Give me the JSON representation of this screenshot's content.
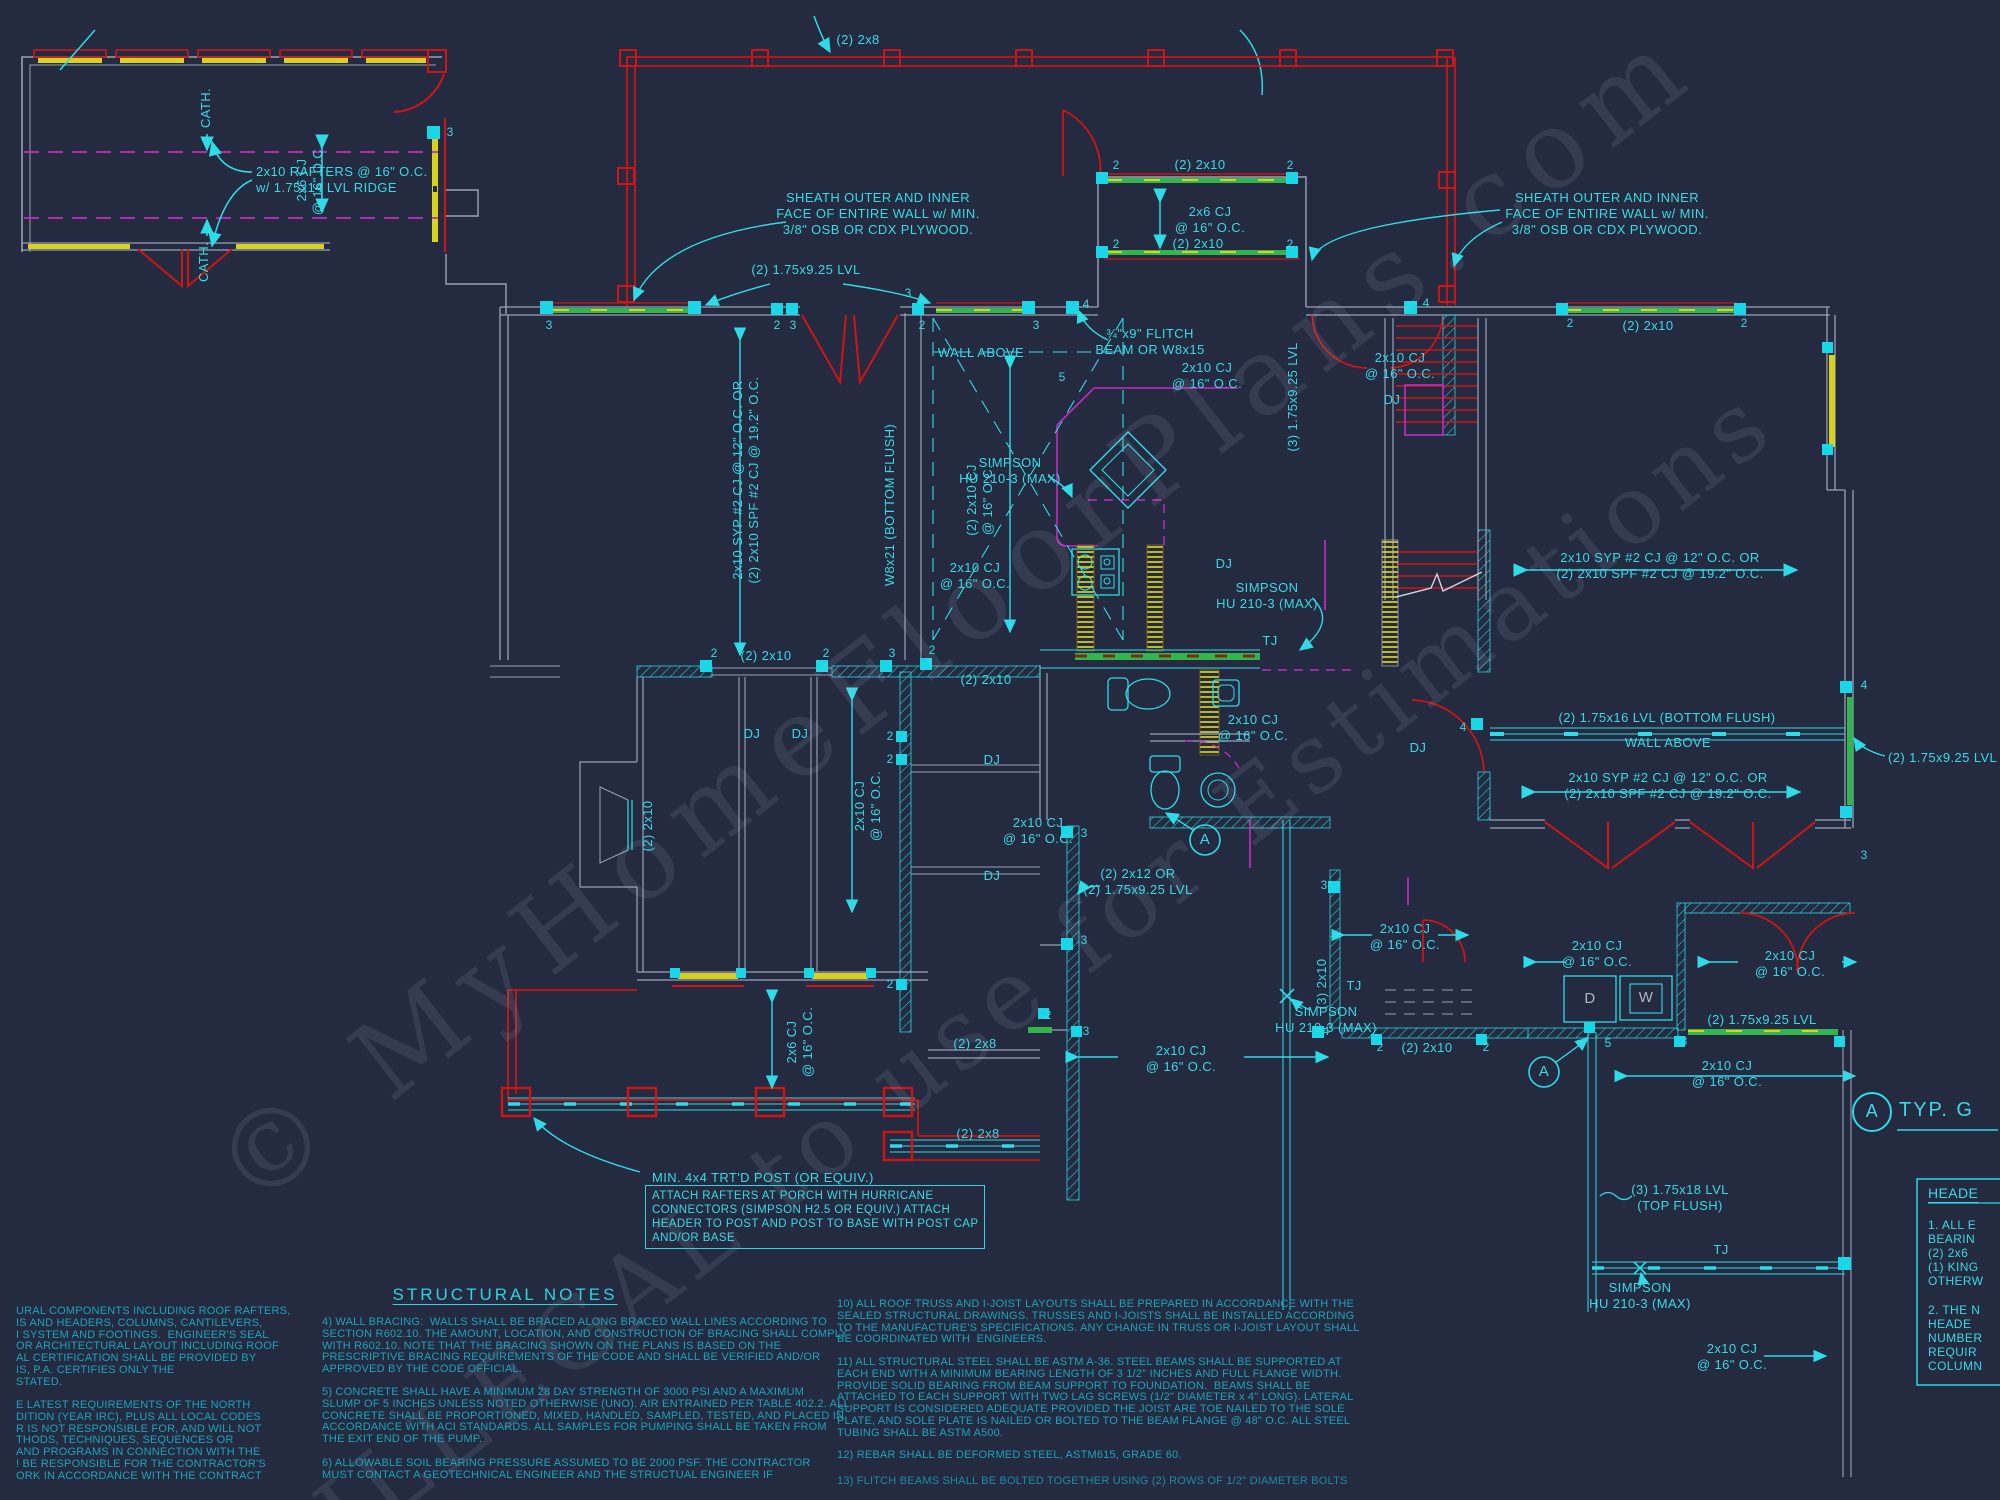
{
  "watermark": {
    "line1": "© MyHomeFloorPlans.com",
    "line2": "ILLEGAL to use for Estimations"
  },
  "colors": {
    "background": "#242a3f",
    "cyan": "#2fdbe6",
    "red": "#cf1414",
    "yellow": "#d8d21f",
    "green": "#33b54e",
    "magenta": "#c32ac3",
    "gray": "#9aa2b6"
  },
  "shared": {
    "cj_2x10": [
      "2x10 CJ",
      "@ 16\" O.C."
    ],
    "cj_2x10_2": [
      "(2) 2x10 CJ",
      "@ 16\" O.C."
    ],
    "cj_2x6": [
      "2x6 CJ",
      "@ 16\" O.C."
    ],
    "two_2x10": "(2) 2x10",
    "two_2x8": "(2) 2x8",
    "lvl_925_2": "(2) 1.75x9.25 LVL",
    "syp": [
      "2x10 SYP #2 CJ @ 12\" O.C. OR",
      "(2) 2x10 SPF #2 CJ @ 19.2\" O.C."
    ],
    "sheath": [
      "SHEATH OUTER AND INNER",
      "FACE OF ENTIRE WALL w/ MIN.",
      "3/8\" OSB OR CDX PLYWOOD."
    ],
    "wall_above": "WALL ABOVE",
    "dj": "DJ",
    "tj": "TJ",
    "simpson": [
      "SIMPSON",
      "HU 210-3 (MAX)"
    ],
    "cath": "CATH.",
    "m2": "2",
    "m3": "3",
    "m4": "4",
    "m5": "5",
    "a": "A"
  },
  "labels": {
    "rafters": [
      "2x10 RAFTERS @ 16\" O.C.",
      "w/ 1.75x14 LVL RIDGE"
    ],
    "flitch": [
      "¾\"x9\" FLITCH",
      "BEAM OR W8x15"
    ],
    "w8x21": "W8x21 (BOTTOM FLUSH)",
    "lvl_925_3": "(3) 1.75x9.25 LVL",
    "lvl_16_2": "(2) 1.75x16 LVL (BOTTOM FLUSH)",
    "two_2x12": [
      "(2) 2x12 OR",
      "(2) 1.75x9.25 LVL"
    ],
    "three_2x10": "(3) 2x10",
    "lvl_18_3": [
      "(3) 1.75x18 LVL",
      "(TOP FLUSH)"
    ],
    "post_min": "MIN. 4x4 TRT'D POST (OR EQUIV.)",
    "attach": [
      "ATTACH RAFTERS AT PORCH WITH HURRICANE",
      "CONNECTORS (SIMPSON H2.5 OR EQUIV.) ATTACH",
      "HEADER TO POST AND POST TO BASE WITH POST CAP",
      "AND/OR BASE"
    ],
    "typ_g": "TYP. G",
    "dryer": "D",
    "washer": "W"
  },
  "structural_notes": {
    "title": "STRUCTURAL NOTES",
    "note4": [
      "4) WALL BRACING:  WALLS SHALL BE BRACED ALONG BRACED WALL LINES ACCORDING TO",
      "SECTION R602.10. THE AMOUNT, LOCATION, AND CONSTRUCTION OF BRACING SHALL COMPLY",
      "WITH R602.10. NOTE THAT THE BRACING SHOWN ON THE PLANS IS BASED ON THE",
      "PRESCRIPTIVE BRACING REQUIREMENTS OF THE CODE AND SHALL BE VERIFIED AND/OR",
      "APPROVED BY THE CODE OFFICIAL."
    ],
    "note5": [
      "5) CONCRETE SHALL HAVE A MINIMUM 28 DAY STRENGTH OF 3000 PSI AND A MAXIMUM",
      "SLUMP OF 5 INCHES UNLESS NOTED OTHERWISE (UNO). AIR ENTRAINED PER TABLE 402.2. ALL",
      "CONCRETE SHALL BE PROPORTIONED, MIXED, HANDLED, SAMPLED, TESTED, AND PLACED IN",
      "ACCORDANCE WITH ACI STANDARDS. ALL SAMPLES FOR PUMPING SHALL BE TAKEN FROM",
      "THE EXIT END OF THE PUMP."
    ],
    "note6": [
      "6) ALLOWABLE SOIL BEARING PRESSURE ASSUMED TO BE 2000 PSF. THE CONTRACTOR",
      "MUST CONTACT A GEOTECHNICAL ENGINEER AND THE STRUCTUAL ENGINEER IF"
    ],
    "note10": [
      "10) ALL ROOF TRUSS AND I-JOIST LAYOUTS SHALL BE PREPARED IN ACCORDANCE WITH THE",
      "SEALED STRUCTURAL DRAWINGS. TRUSSES AND I-JOISTS SHALL BE INSTALLED ACCORDING",
      "TO THE MANUFACTURE'S SPECIFICATIONS. ANY CHANGE IN TRUSS OR I-JOIST LAYOUT SHALL",
      "BE COORDINATED WITH  ENGINEERS."
    ],
    "note11": [
      "11) ALL STRUCTURAL STEEL SHALL BE ASTM A-36. STEEL BEAMS SHALL BE SUPPORTED AT",
      "EACH END WITH A MINIMUM BEARING LENGTH OF 3 1/2\" INCHES AND FULL FLANGE WIDTH.",
      "PROVIDE SOLID BEARING FROM BEAM SUPPORT TO FOUNDATION.  BEAMS SHALL BE",
      "ATTACHED TO EACH SUPPORT WITH TWO LAG SCREWS (1/2\" DIAMETER x 4\" LONG). LATERAL",
      "SUPPORT IS CONSIDERED ADEQUATE PROVIDED THE JOIST ARE TOE NAILED TO THE SOLE",
      "PLATE, AND SOLE PLATE IS NAILED OR BOLTED TO THE BEAM FLANGE @ 48\" O.C. ALL STEEL",
      "TUBING SHALL BE ASTM A500."
    ],
    "note12": "12) REBAR SHALL BE DEFORMED STEEL, ASTM615, GRADE 60.",
    "note13": "13) FLITCH BEAMS SHALL BE BOLTED TOGETHER USING (2) ROWS OF 1/2\" DIAMETER BOLTS"
  },
  "left_notes": {
    "para1": [
      "URAL COMPONENTS INCLUDING ROOF RAFTERS,",
      "IS AND HEADERS, COLUMNS, CANTILEVERS,",
      "I SYSTEM AND FOOTINGS.  ENGINEER'S SEAL",
      "OR ARCHITECTURAL LAYOUT INCLUDING ROOF",
      "AL CERTIFICATION SHALL BE PROVIDED BY",
      "IS, P.A. CERTIFIES ONLY THE",
      "STATED."
    ],
    "para2": [
      "E LATEST REQUIREMENTS OF THE NORTH",
      "DITION (YEAR IRC), PLUS ALL LOCAL CODES",
      "R IS NOT RESPONSIBLE FOR, AND WILL NOT",
      "THODS, TECHNIQUES, SEQUENCES OR",
      "AND PROGRAMS IN CONNECTION WITH THE",
      "! BE RESPONSIBLE FOR THE CONTRACTOR'S",
      "ORK IN ACCORDANCE WITH THE CONTRACT"
    ]
  },
  "header_notes": {
    "title": "HEADE",
    "para1": [
      "1. ALL E",
      "BEARIN",
      "(2) 2x6",
      "(1) KING",
      "OTHERW"
    ],
    "para2": [
      "2. THE N",
      "HEADE",
      "NUMBER",
      "REQUIR",
      "COLUMN"
    ]
  }
}
